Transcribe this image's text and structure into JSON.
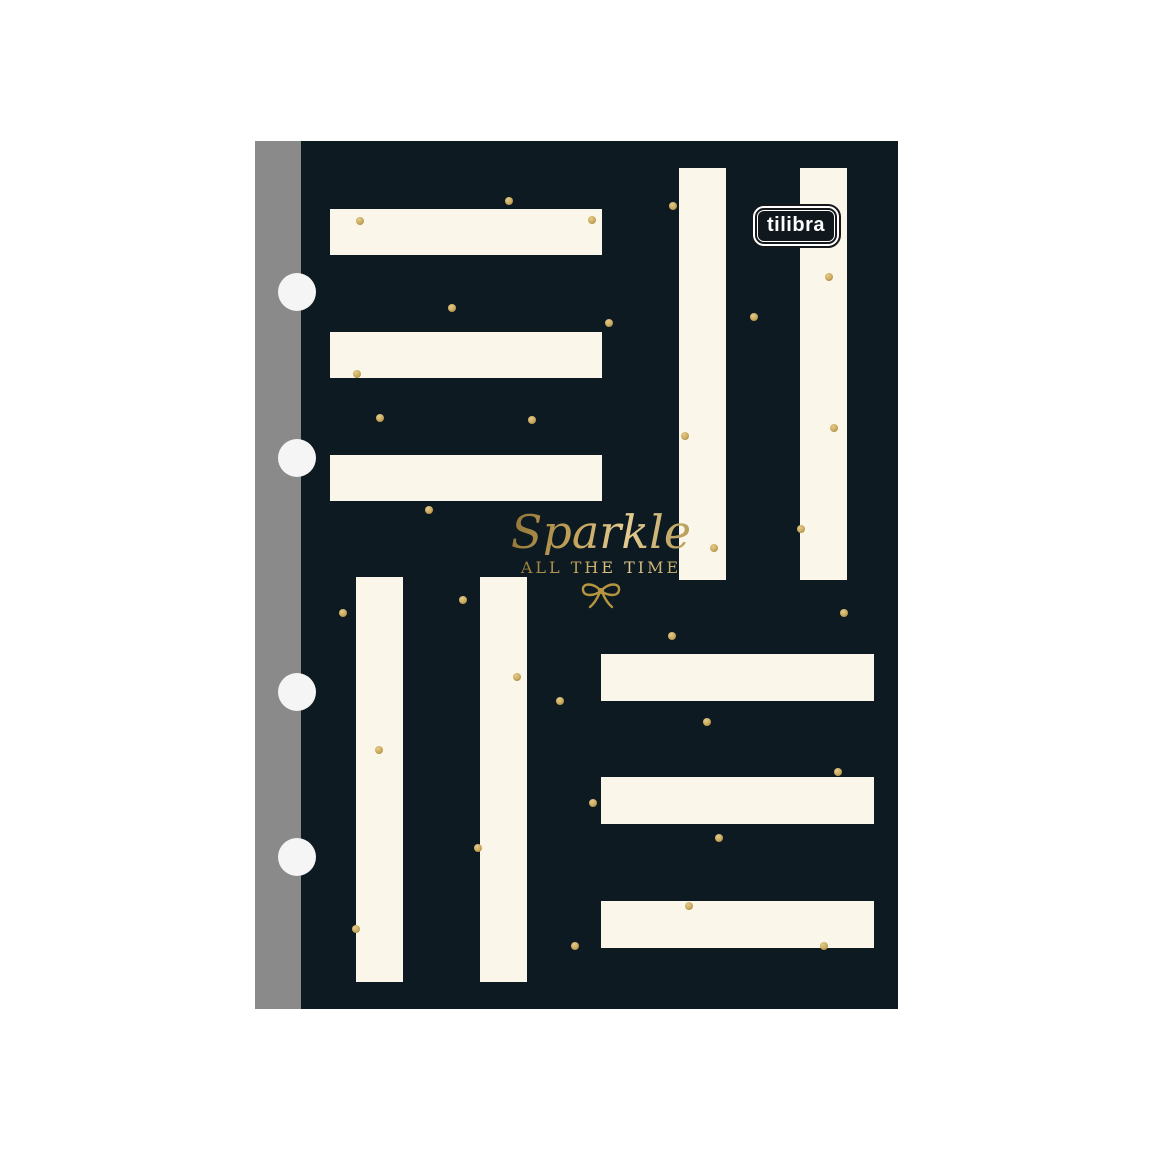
{
  "product": {
    "brand_logo": "tilibra",
    "title": "Sparkle",
    "subtitle": "ALL THE TIME"
  },
  "colors": {
    "background": "#ffffff",
    "cover": "#0d1a22",
    "spine": "#8a8a8a",
    "stripe": "#fbf6ea",
    "hole": "#f5f5f5",
    "dot": "#c9a85c",
    "dot_ring": "#94772f",
    "gold": "#b5953f",
    "logo_bg": "#10181e",
    "logo_text": "#ffffff"
  },
  "pattern": {
    "stripes": [
      {
        "x": 29,
        "y": 68,
        "w": 272,
        "h": 46
      },
      {
        "x": 29,
        "y": 191,
        "w": 272,
        "h": 46
      },
      {
        "x": 29,
        "y": 314,
        "w": 272,
        "h": 46
      },
      {
        "x": 378,
        "y": 27,
        "w": 47,
        "h": 412
      },
      {
        "x": 499,
        "y": 27,
        "w": 47,
        "h": 412
      },
      {
        "x": 55,
        "y": 436,
        "w": 47,
        "h": 405
      },
      {
        "x": 179,
        "y": 436,
        "w": 47,
        "h": 405
      },
      {
        "x": 300,
        "y": 513,
        "w": 273,
        "h": 47
      },
      {
        "x": 300,
        "y": 636,
        "w": 273,
        "h": 47
      },
      {
        "x": 300,
        "y": 760,
        "w": 273,
        "h": 47
      }
    ],
    "dots": [
      {
        "x": 208,
        "y": 60
      },
      {
        "x": 59,
        "y": 80
      },
      {
        "x": 291,
        "y": 79
      },
      {
        "x": 151,
        "y": 167
      },
      {
        "x": 308,
        "y": 182
      },
      {
        "x": 56,
        "y": 233
      },
      {
        "x": 79,
        "y": 277
      },
      {
        "x": 231,
        "y": 279
      },
      {
        "x": 128,
        "y": 369
      },
      {
        "x": 372,
        "y": 65
      },
      {
        "x": 528,
        "y": 136
      },
      {
        "x": 453,
        "y": 176
      },
      {
        "x": 384,
        "y": 295
      },
      {
        "x": 533,
        "y": 287
      },
      {
        "x": 500,
        "y": 388
      },
      {
        "x": 413,
        "y": 407
      },
      {
        "x": 371,
        "y": 495
      },
      {
        "x": 259,
        "y": 560
      },
      {
        "x": 406,
        "y": 581
      },
      {
        "x": 537,
        "y": 631
      },
      {
        "x": 292,
        "y": 662
      },
      {
        "x": 418,
        "y": 697
      },
      {
        "x": 388,
        "y": 765
      },
      {
        "x": 523,
        "y": 805
      },
      {
        "x": 274,
        "y": 805
      },
      {
        "x": 42,
        "y": 472
      },
      {
        "x": 162,
        "y": 459
      },
      {
        "x": 216,
        "y": 536
      },
      {
        "x": 78,
        "y": 609
      },
      {
        "x": 177,
        "y": 707
      },
      {
        "x": 55,
        "y": 788
      },
      {
        "x": 543,
        "y": 472
      }
    ],
    "holes": [
      {
        "cx": 42,
        "cy": 151
      },
      {
        "cx": 42,
        "cy": 317
      },
      {
        "cx": 42,
        "cy": 551
      },
      {
        "cx": 42,
        "cy": 716
      }
    ]
  }
}
